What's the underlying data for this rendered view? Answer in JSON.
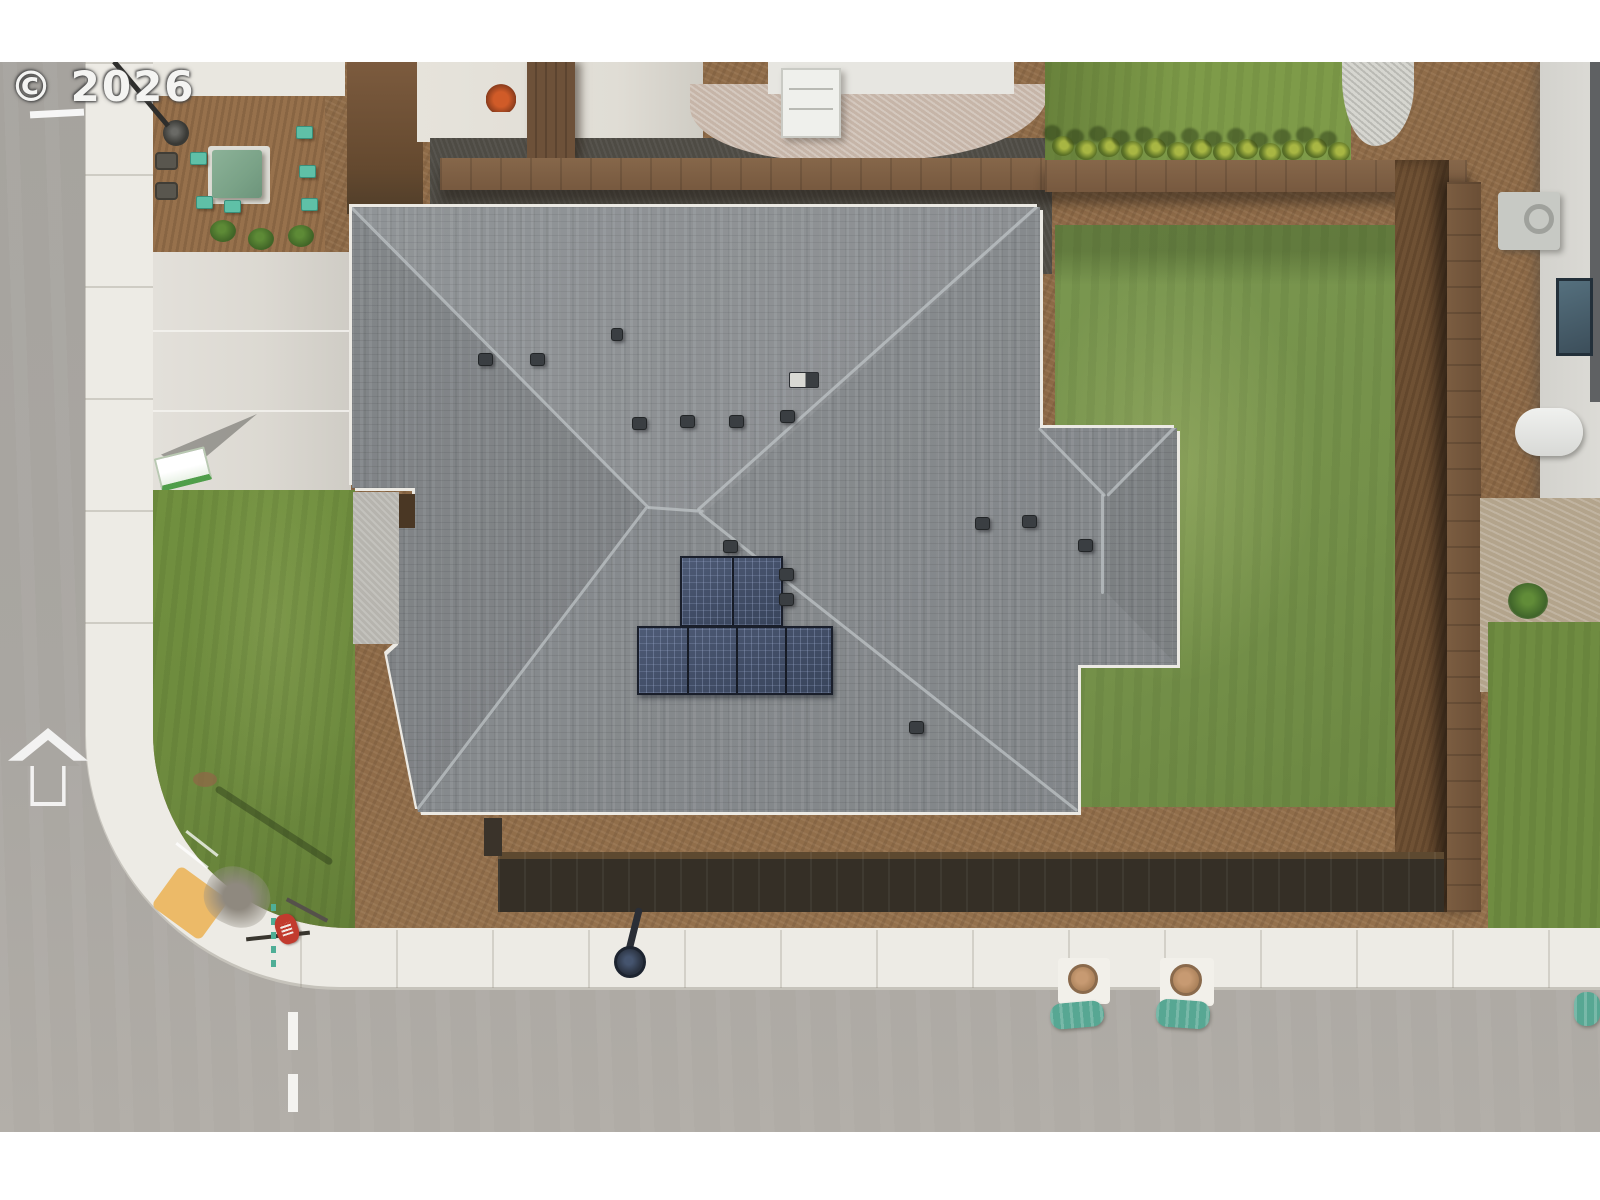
{
  "watermark": {
    "text": "© 2026",
    "color": "#f4f4f2"
  },
  "scene": {
    "type": "aerial-drone-photo",
    "description": "Top-down aerial view of a newly built single-family house on a corner lot: gray hip shingle roof with six rooftop solar panels, new sod lawns, bark mulch beds, wooden fences, concrete driveway, curved white sidewalk, asphalt streets, and neighboring homes at the top and right edges.",
    "letterbox_color": "#ffffff",
    "colors": {
      "road": "#a9a6a1",
      "sidewalk": "#edebe5",
      "driveway": "#dcd9d2",
      "roof_shingle": "#868a8d",
      "roof_fascia": "#eceae4",
      "solar_panel": "#414d66",
      "front_lawn": "#6d8a3e",
      "backyard_lawn": "#75914a",
      "mulch": "#8f6c49",
      "dark_gravel": "#4e4b44",
      "fence_wood": "#77593f",
      "fence_shadow": "#352f26",
      "transformer_green": "#7aa287",
      "utility_teal": "#5fc0a7",
      "ada_ramp_yellow": "#ecba68",
      "stop_sign_red": "#c23b2e",
      "neighbor_wall": "#d8d7d2",
      "white_gravel": "#d6d6d0"
    },
    "counts": {
      "solar_panels_top_row": 2,
      "solar_panels_bottom_row": 4,
      "arborvitae_shrubs": 13,
      "roof_vents": 14
    },
    "objects": [
      "hip-roof-house",
      "solar-array",
      "roof-vents",
      "chimney",
      "entry-porch",
      "concrete-driveway",
      "front-lawn",
      "backyard-lawn",
      "mulch-beds",
      "utility-transformer",
      "utility-boxes",
      "street-light",
      "stop-sign",
      "ada-curb-ramp",
      "curved-sidewalk",
      "asphalt-road",
      "road-arrow-marking",
      "dashed-center-line",
      "wood-privacy-fence",
      "arborvitae-row",
      "neighbor-house-top",
      "neighbor-house-right",
      "ac-unit",
      "water-tank",
      "manhole-covers",
      "erosion-wattles",
      "yard-sign"
    ]
  }
}
